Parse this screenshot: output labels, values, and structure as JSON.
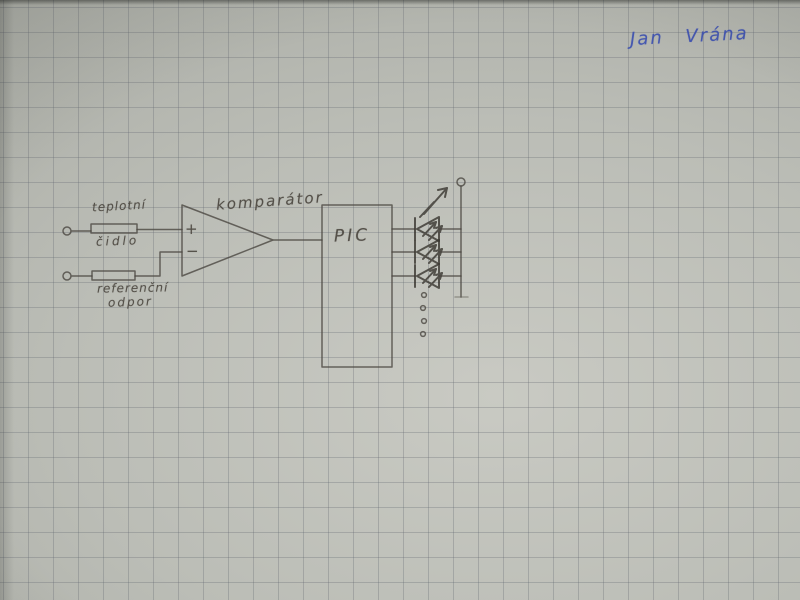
{
  "photo": {
    "description": "hand-drawn circuit schematic on squared graph paper",
    "paper_color": "#b9bbb5",
    "grid_color": "#60656e",
    "grid_size_px": 25,
    "pencil_color": "#4b4741"
  },
  "signature": {
    "name": "Jan Vrána",
    "ink_color": "#3c50b0"
  },
  "labels": {
    "temperature_sensor_line1": "teplotní",
    "temperature_sensor_line2": "čidlo",
    "reference_resistor_line1": "referenční",
    "reference_resistor_line2": "odpor",
    "comparator": "komparátor",
    "comparator_plus": "+",
    "comparator_minus": "−",
    "pic": "PIC"
  },
  "components": {
    "input_terminals": 2,
    "resistors": [
      "teplotní čidlo",
      "referenční odpor"
    ],
    "comparator": "komparátor",
    "controller": "PIC",
    "led_count": 3,
    "more_outputs_dots": 4,
    "output_terminal": 1
  }
}
